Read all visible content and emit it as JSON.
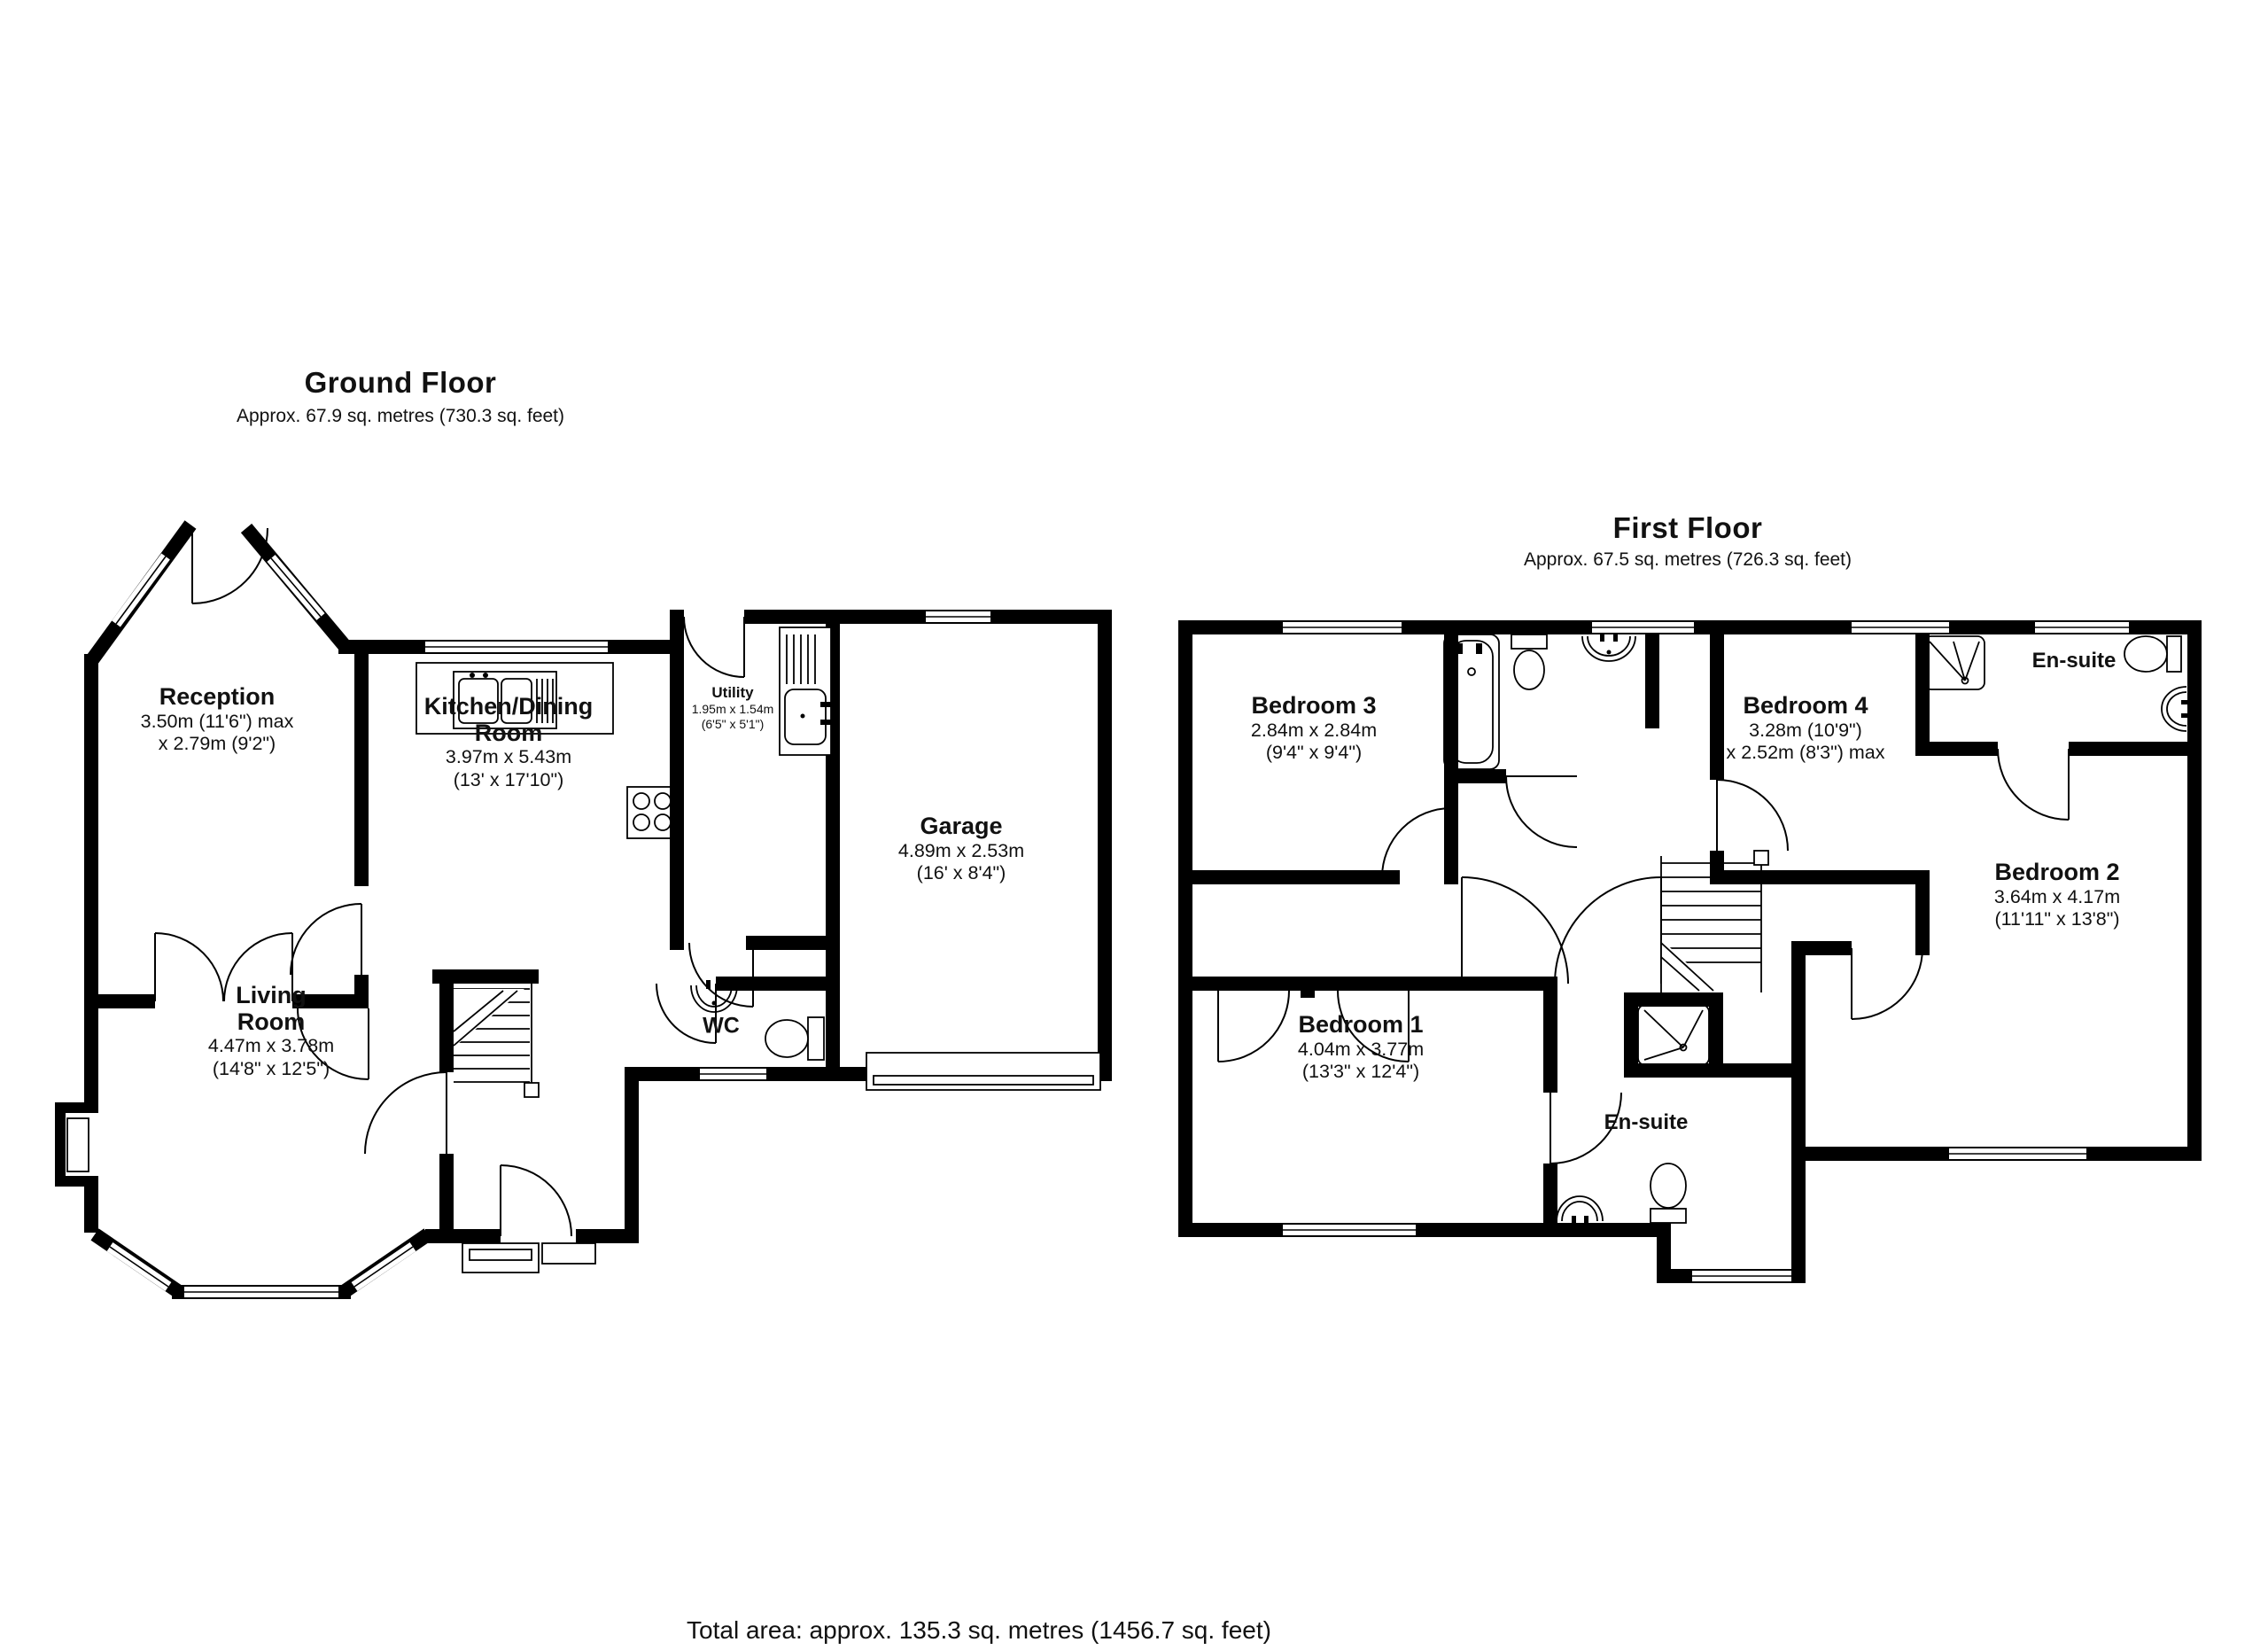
{
  "total_area": "Total area: approx. 135.3 sq. metres (1456.7 sq. feet)",
  "ground_floor": {
    "title": "Ground Floor",
    "subtitle": "Approx. 67.9 sq. metres (730.3 sq. feet)",
    "rooms": {
      "reception": {
        "name": "Reception",
        "dims": [
          "3.50m (11'6\") max",
          "x 2.79m (9'2\")"
        ]
      },
      "kitchen": {
        "name": "Kitchen/Dining",
        "name2": "Room",
        "dims": [
          "3.97m x 5.43m",
          "(13' x 17'10\")"
        ]
      },
      "utility": {
        "name": "Utility",
        "dims": [
          "1.95m x 1.54m",
          "(6'5\" x 5'1\")"
        ]
      },
      "garage": {
        "name": "Garage",
        "dims": [
          "4.89m x 2.53m",
          "(16' x 8'4\")"
        ]
      },
      "living": {
        "name": "Living",
        "name2": "Room",
        "dims": [
          "4.47m x 3.78m",
          "(14'8\" x 12'5\")"
        ]
      },
      "wc": {
        "name": "WC"
      }
    }
  },
  "first_floor": {
    "title": "First Floor",
    "subtitle": "Approx. 67.5 sq. metres (726.3 sq. feet)",
    "rooms": {
      "bedroom1": {
        "name": "Bedroom 1",
        "dims": [
          "4.04m x 3.77m",
          "(13'3\" x 12'4\")"
        ]
      },
      "bedroom2": {
        "name": "Bedroom 2",
        "dims": [
          "3.64m x 4.17m",
          "(11'11\" x 13'8\")"
        ]
      },
      "bedroom3": {
        "name": "Bedroom 3",
        "dims": [
          "2.84m x 2.84m",
          "(9'4\" x 9'4\")"
        ]
      },
      "bedroom4": {
        "name": "Bedroom 4",
        "dims": [
          "3.28m (10'9\")",
          "x 2.52m (8'3\") max"
        ]
      },
      "ensuite_top": {
        "name": "En-suite"
      },
      "ensuite_bottom": {
        "name": "En-suite"
      }
    }
  }
}
